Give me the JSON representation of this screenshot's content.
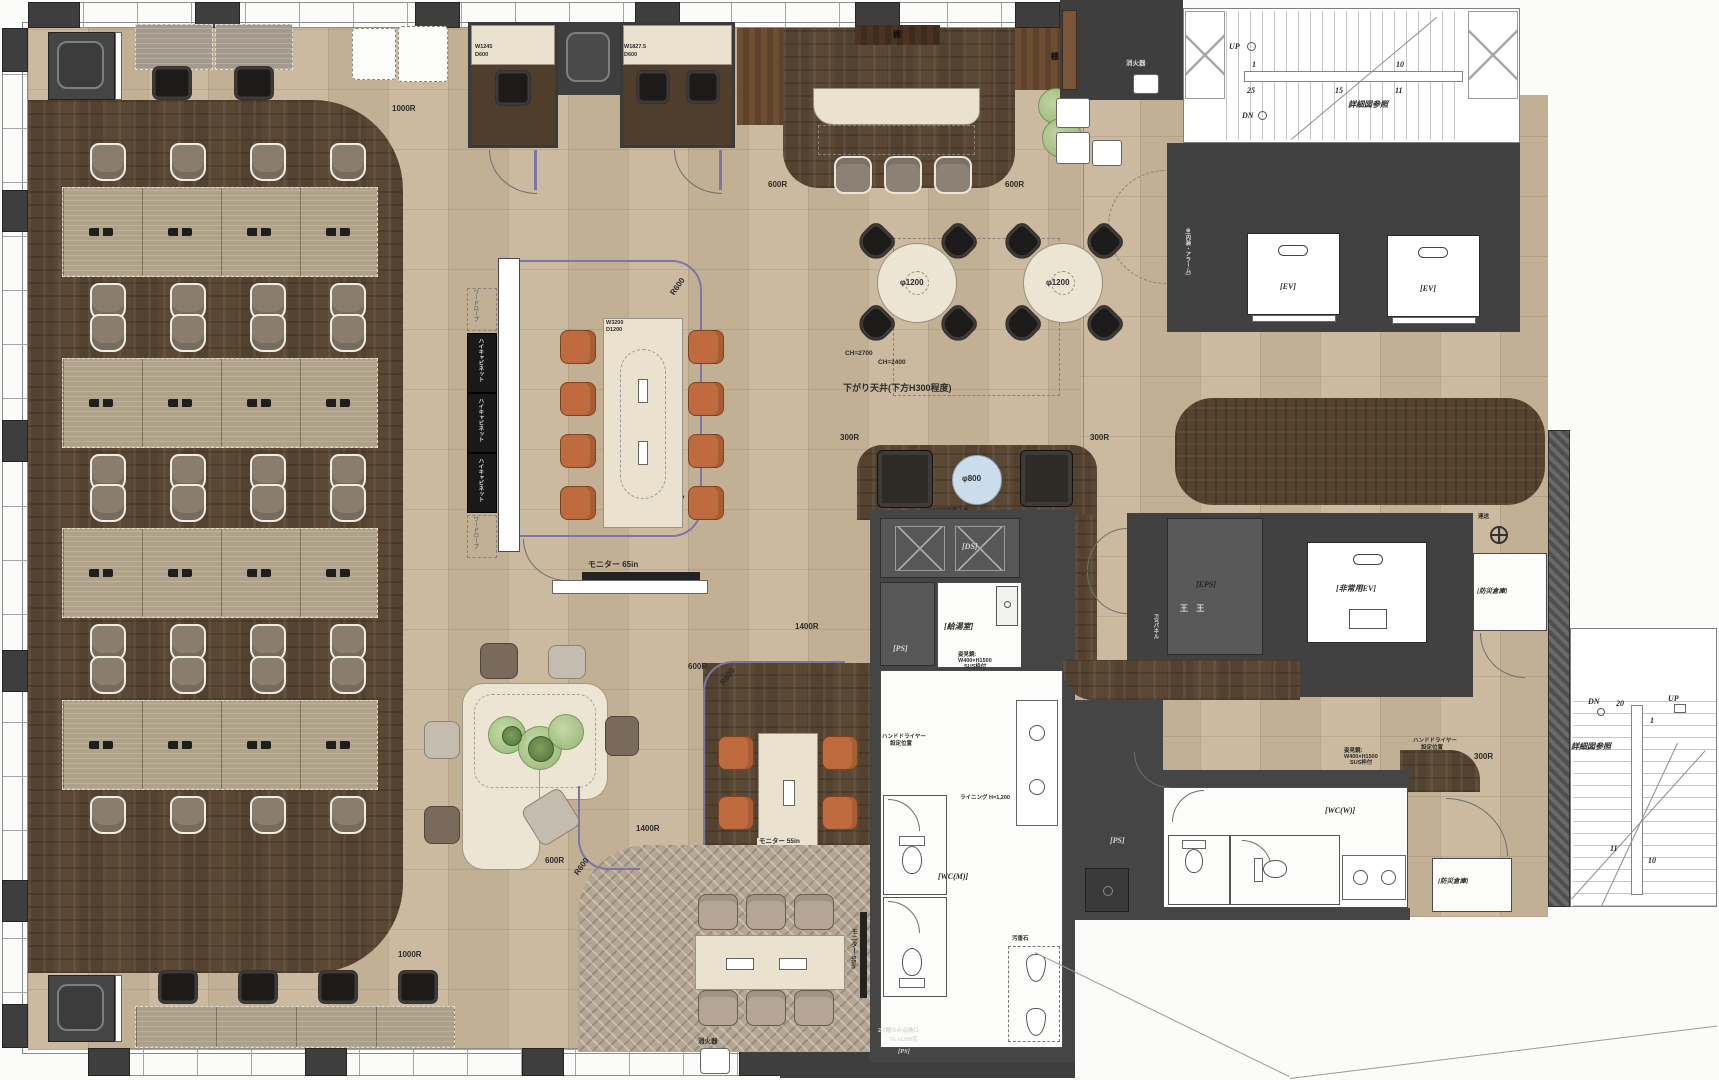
{
  "palette": {
    "floor_beige": "#c8b69a",
    "carpet_brown": "#5a4734",
    "accent_purple": "#7d74a8",
    "chair_orange": "#bf6b3f",
    "table_cream": "#eae2cf",
    "round_table_blue": "#cbdcec",
    "plant_green": "#a8c68f",
    "wall_gray": "#3e3e3e"
  },
  "dims": {
    "r1000": "1000R",
    "r600": "600R",
    "r600r": "R600",
    "r300": "300R",
    "r1400": "1400R"
  },
  "booths": {
    "a_w": "W1245",
    "a_d": "D600",
    "b_w": "W1827.5",
    "b_d": "D600"
  },
  "bar": {
    "shelf": "棚"
  },
  "round_tables": {
    "label": "φ1200",
    "ch1": "CH=2700",
    "ch2": "CH=2400",
    "ceiling_note": "下がり天井(下方H300程度)"
  },
  "meeting": {
    "table_w": "W3200",
    "table_d": "D1200",
    "cabinet": "ハイキャビネット",
    "wardrobe": "ワードローブ",
    "monitor": "モニター 65in"
  },
  "small_meeting": {
    "monitor": "モニター 55in"
  },
  "stone_meeting": {
    "monitor": "モニター 55in"
  },
  "lounge": {
    "table": "φ800",
    "note": "マグサ設置下地"
  },
  "core": {
    "ds": "[DS]",
    "ps": "[PS]",
    "kitchen": "[給湯室]",
    "wc_m": "[WC(M)]",
    "mirror1": "姿見鏡:",
    "mirror2": "W400×H1500",
    "mirror3": "SUS枠付",
    "dryer1": "ハンドドライヤー",
    "dryer2": "設定位置",
    "lining": "ライニング H=1,200",
    "osui": "汚垂石",
    "hatch1": "2,7階のみ点検口",
    "hatch2": "FL+1200芯"
  },
  "wc_w": {
    "label": "[WC(W)]"
  },
  "ev": {
    "ev": "[EV]",
    "emergency": "[非常用EV]",
    "eps": "[EPS]",
    "bousai": "[防災倉庫]",
    "rensou": "連送",
    "fix_panel": "FIXパネル",
    "wall_note": "⊕[内装・アラーム]",
    "marks": "王 王"
  },
  "fire": {
    "label": "消火器"
  },
  "stairs_top": {
    "up": "UP",
    "dn": "DN",
    "n1": "1",
    "n10": "10",
    "n11": "11",
    "n15": "15",
    "n25": "25",
    "detail": "詳細図参照"
  },
  "stairs_bottom": {
    "up": "UP",
    "dn": "DN",
    "n1": "1",
    "n10": "10",
    "n11": "11",
    "n20": "20",
    "detail": "詳細図参照"
  }
}
